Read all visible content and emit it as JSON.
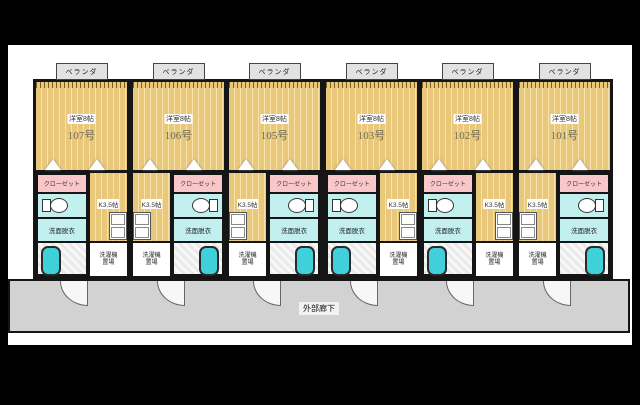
{
  "plan": {
    "labels": {
      "balcony": "ベランダ",
      "room_size": "洋室8帖",
      "closet": "クローゼット",
      "kitchen": "K3.5帖",
      "washroom": "洗面脱衣",
      "laundry_line1": "洗濯機",
      "laundry_line2": "置場",
      "corridor": "外部廊下"
    },
    "units": [
      {
        "number": "107号",
        "plumbing_side": "left"
      },
      {
        "number": "106号",
        "plumbing_side": "right"
      },
      {
        "number": "105号",
        "plumbing_side": "right"
      },
      {
        "number": "103号",
        "plumbing_side": "left"
      },
      {
        "number": "102号",
        "plumbing_side": "left"
      },
      {
        "number": "101号",
        "plumbing_side": "right"
      }
    ],
    "colors": {
      "room_floor": "#e9c87c",
      "closet": "#f9c6ca",
      "water_rooms": "#c2f0ee",
      "bathtub": "#3fd0da",
      "corridor": "#d2d2d2",
      "walls": "#151515",
      "background": "#000000"
    }
  }
}
